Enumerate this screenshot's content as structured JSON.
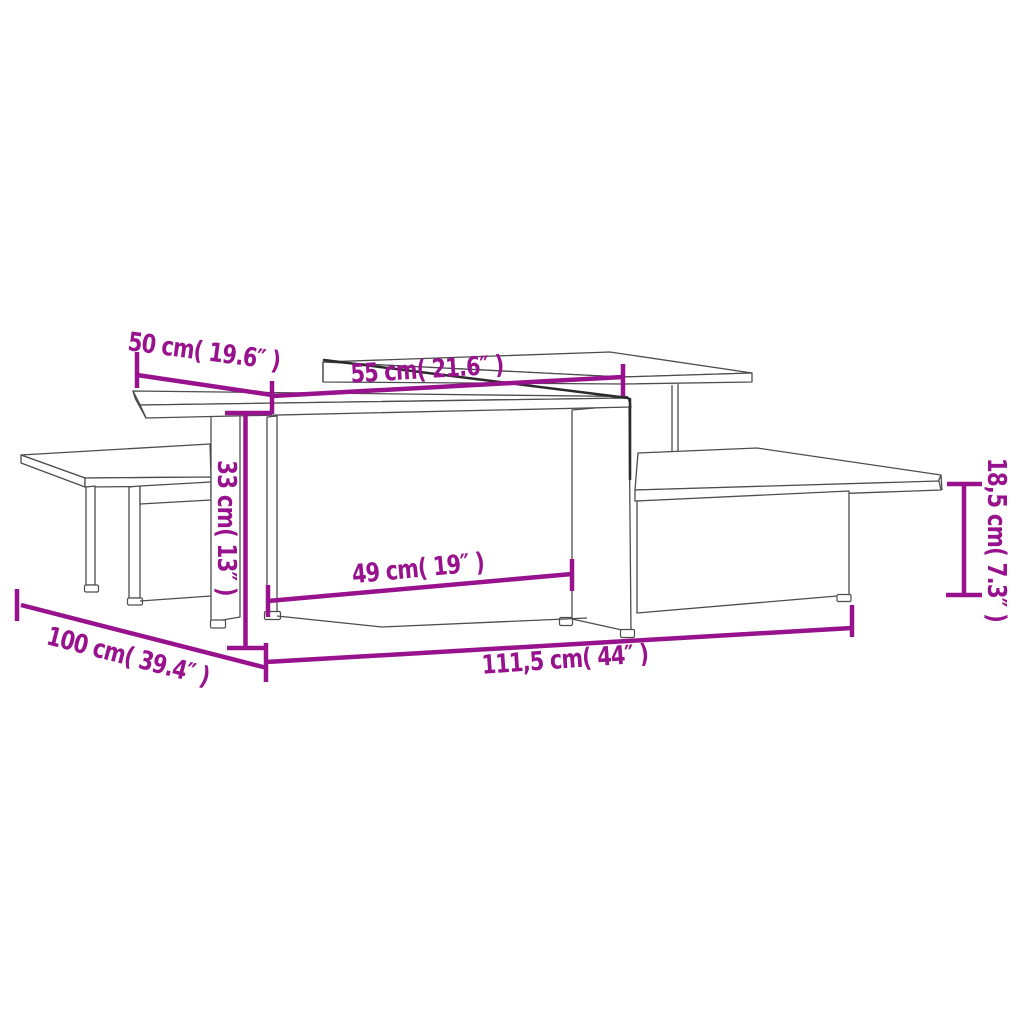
{
  "page": {
    "background": "#ffffff"
  },
  "diagram": {
    "kind": "product-dimension-diagram",
    "subject": "nesting coffee tables (2 pcs) line drawing",
    "accent_color": "#98128E",
    "line_color": "#4d4d4d",
    "dimensions": [
      {
        "id": "top-depth",
        "cm": "50",
        "inch": "19.6",
        "label": "50 cm( 19.6″ )"
      },
      {
        "id": "upper-top-length",
        "cm": "55",
        "inch": "21.6",
        "label": "55 cm( 21.6″ )"
      },
      {
        "id": "total-height",
        "cm": "33",
        "inch": "13",
        "label": "33 cm( 13″ )"
      },
      {
        "id": "inner-clear-width",
        "cm": "49",
        "inch": "19",
        "label": "49 cm( 19″ )"
      },
      {
        "id": "total-length",
        "cm": "111,5",
        "inch": "44",
        "label": "111,5 cm( 44″ )"
      },
      {
        "id": "assembled-depth",
        "cm": "100",
        "inch": "39.4",
        "label": "100 cm( 39.4″ )"
      },
      {
        "id": "shelf-clearance",
        "cm": "18,5",
        "inch": "7.3",
        "label": "18,5 cm( 7.3″ )"
      }
    ]
  }
}
